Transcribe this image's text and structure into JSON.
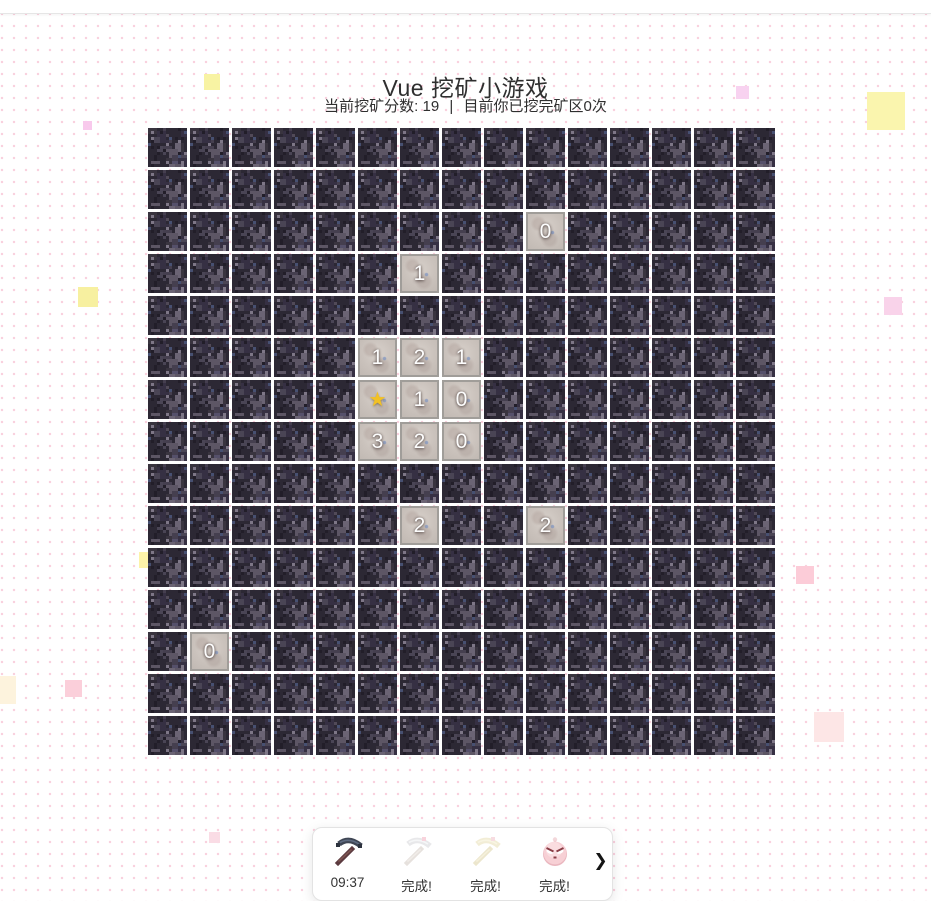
{
  "page": {
    "title": "Vue 挖矿小游戏"
  },
  "status": {
    "score_label": "当前挖矿分数:",
    "score": "19",
    "divider": "|",
    "rounds_prefix": "目前你已挖完矿区",
    "rounds_count": "0",
    "rounds_suffix": "次"
  },
  "grid": {
    "rows": 15,
    "cols": 15,
    "tile_style": "dark-bedrock-texture",
    "revealed": [
      {
        "row": 2,
        "col": 9,
        "value": "0"
      },
      {
        "row": 3,
        "col": 6,
        "value": "1"
      },
      {
        "row": 5,
        "col": 5,
        "value": "1"
      },
      {
        "row": 5,
        "col": 6,
        "value": "2"
      },
      {
        "row": 5,
        "col": 7,
        "value": "1"
      },
      {
        "row": 6,
        "col": 5,
        "value": "★"
      },
      {
        "row": 6,
        "col": 6,
        "value": "1"
      },
      {
        "row": 6,
        "col": 7,
        "value": "0"
      },
      {
        "row": 7,
        "col": 5,
        "value": "3"
      },
      {
        "row": 7,
        "col": 6,
        "value": "2"
      },
      {
        "row": 7,
        "col": 7,
        "value": "0"
      },
      {
        "row": 9,
        "col": 6,
        "value": "2"
      },
      {
        "row": 9,
        "col": 9,
        "value": "2"
      },
      {
        "row": 12,
        "col": 1,
        "value": "0"
      }
    ],
    "star_color": "#f2c125"
  },
  "toolbar": {
    "items": [
      {
        "icon": "netherite-pickaxe-icon",
        "label": "09:37",
        "faded": false
      },
      {
        "icon": "iron-pickaxe-icon",
        "label": "完成!",
        "faded": true
      },
      {
        "icon": "gold-pickaxe-icon",
        "label": "完成!",
        "faded": true
      },
      {
        "icon": "pink-orb-icon",
        "label": "完成!",
        "faded": false
      }
    ],
    "next_glyph": "❯"
  },
  "colors": {
    "bedrock_base": "#2c2834",
    "bedrock_palette": [
      "#514a58",
      "#5d5665",
      "#453f4f",
      "#6b6474",
      "#39343f",
      "#55506a",
      "#4a4555",
      "#363043"
    ],
    "revealed_tile": "#cac2bc",
    "dot_pattern": "#f9cfdd"
  },
  "decorations": [
    {
      "x": 204,
      "y": 74,
      "size": 16,
      "color": "#f8f3a3"
    },
    {
      "x": 736,
      "y": 86,
      "size": 13,
      "color": "#f8d2f0"
    },
    {
      "x": 867,
      "y": 92,
      "size": 38,
      "color": "#faf5ae"
    },
    {
      "x": 83,
      "y": 121,
      "size": 9,
      "color": "#f8c9ec"
    },
    {
      "x": 78,
      "y": 287,
      "size": 20,
      "color": "#f7f0a0"
    },
    {
      "x": 884,
      "y": 297,
      "size": 18,
      "color": "#f9d3ea"
    },
    {
      "x": 139,
      "y": 552,
      "size": 16,
      "color": "#fdf3a9"
    },
    {
      "x": 796,
      "y": 566,
      "size": 18,
      "color": "#fcccd8"
    },
    {
      "x": -12,
      "y": 676,
      "size": 28,
      "color": "#fdf3dd"
    },
    {
      "x": 65,
      "y": 680,
      "size": 17,
      "color": "#fbcfda"
    },
    {
      "x": 814,
      "y": 712,
      "size": 30,
      "color": "#fde6e6"
    },
    {
      "x": 209,
      "y": 832,
      "size": 11,
      "color": "#fadce5"
    }
  ]
}
